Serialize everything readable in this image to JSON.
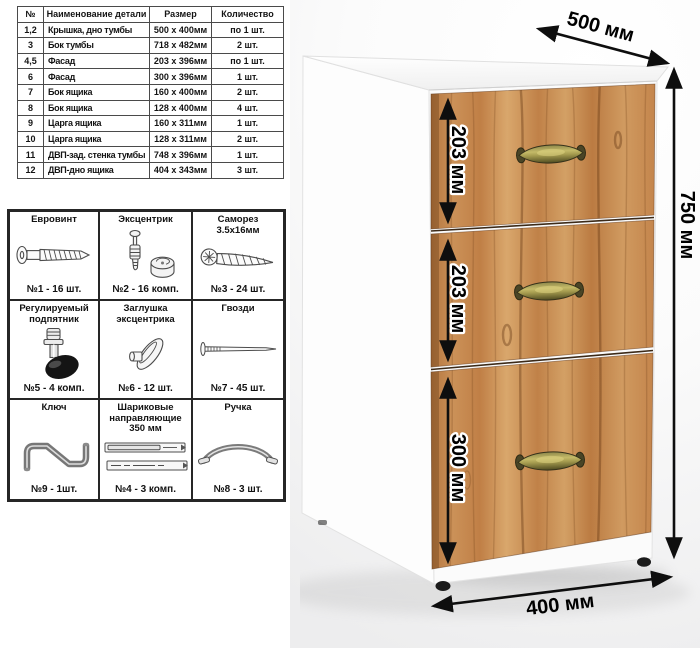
{
  "parts_table": {
    "headers": [
      "№",
      "Наименование детали",
      "Размер",
      "Количество"
    ],
    "rows": [
      [
        "1,2",
        "Крышка, дно тумбы",
        "500 x 400мм",
        "по 1 шт."
      ],
      [
        "3",
        "Бок тумбы",
        "718 x 482мм",
        "2 шт."
      ],
      [
        "4,5",
        "Фасад",
        "203 x 396мм",
        "по 1 шт."
      ],
      [
        "6",
        "Фасад",
        "300 x 396мм",
        "1 шт."
      ],
      [
        "7",
        "Бок ящика",
        "160 x 400мм",
        "2 шт."
      ],
      [
        "8",
        "Бок ящика",
        "128 x 400мм",
        "4 шт."
      ],
      [
        "9",
        "Царга ящика",
        "160 x 311мм",
        "1 шт."
      ],
      [
        "10",
        "Царга ящика",
        "128 x 311мм",
        "2 шт."
      ],
      [
        "11",
        "ДВП-зад. стенка тумбы",
        "748 x 396мм",
        "1 шт."
      ],
      [
        "12",
        "ДВП-дно ящика",
        "404 x 343мм",
        "3 шт."
      ]
    ]
  },
  "hardware": {
    "items": [
      {
        "title": "Евровинт",
        "count": "№1 - 16 шт."
      },
      {
        "title": "Эксцентрик",
        "count": "№2 - 16 комп."
      },
      {
        "title": "Саморез 3.5х16мм",
        "count": "№3 - 24 шт."
      },
      {
        "title": "Регулируемый подпятник",
        "count": "№5 - 4 комп."
      },
      {
        "title": "Заглушка эксцентрика",
        "count": "№6 - 12 шт."
      },
      {
        "title": "Гвозди",
        "count": "№7 - 45 шт."
      },
      {
        "title": "Ключ",
        "count": "№9 - 1шт."
      },
      {
        "title": "Шариковые направляющие 350 мм",
        "count": "№4 - 3 комп."
      },
      {
        "title": "Ручка",
        "count": "№8 - 3 шт."
      }
    ]
  },
  "cabinet": {
    "dim_width": "500 мм",
    "dim_height": "750 мм",
    "dim_depth": "400 мм",
    "drawers": [
      "203 мм",
      "203 мм",
      "300 мм"
    ],
    "colors": {
      "wood": "#c98a55",
      "wood_dark": "#a86f3e",
      "wood_light": "#dba873",
      "handle_brass": "#a79d50",
      "feet": "#1b1b1b",
      "dimension_text": "#000000"
    }
  }
}
